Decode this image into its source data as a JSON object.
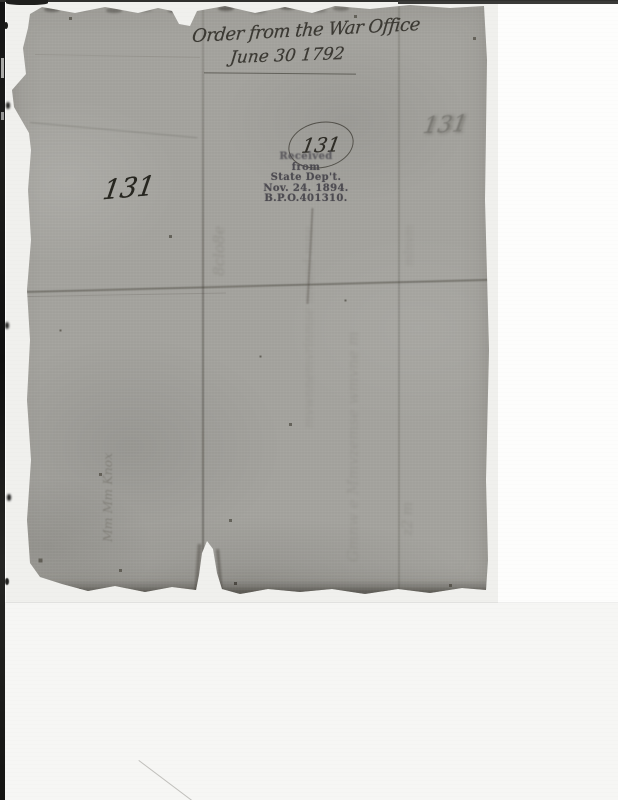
{
  "annotations": {
    "docket_line1": "Order from the War Office",
    "docket_line2": "June 30 1792",
    "number_left": "131",
    "number_circled": "131",
    "number_right_faint": "131"
  },
  "stamp": {
    "lines": [
      "Received",
      "from",
      "State Dep't.",
      "Nov. 24. 1894.",
      "B.P.O.401310."
    ]
  },
  "ghost_writing": {
    "left_vertical": "Mm Mm Knox",
    "loops_by_fold": "8clo8e",
    "column_center_upper": "mvwnnemvrinmse mvund mne",
    "column_center_lower": "Gmnw e Mmvzemse wmvne m",
    "column_right_upper": "mlnvm",
    "column_right_lower": "z2 m"
  },
  "colors": {
    "paper": "#a5a49f",
    "handwriting_ink": "#3b3933",
    "stamp_ink": "#4e4c52",
    "scanner_border": "#1a1a18",
    "scan_bed": "#f6f6f4"
  }
}
